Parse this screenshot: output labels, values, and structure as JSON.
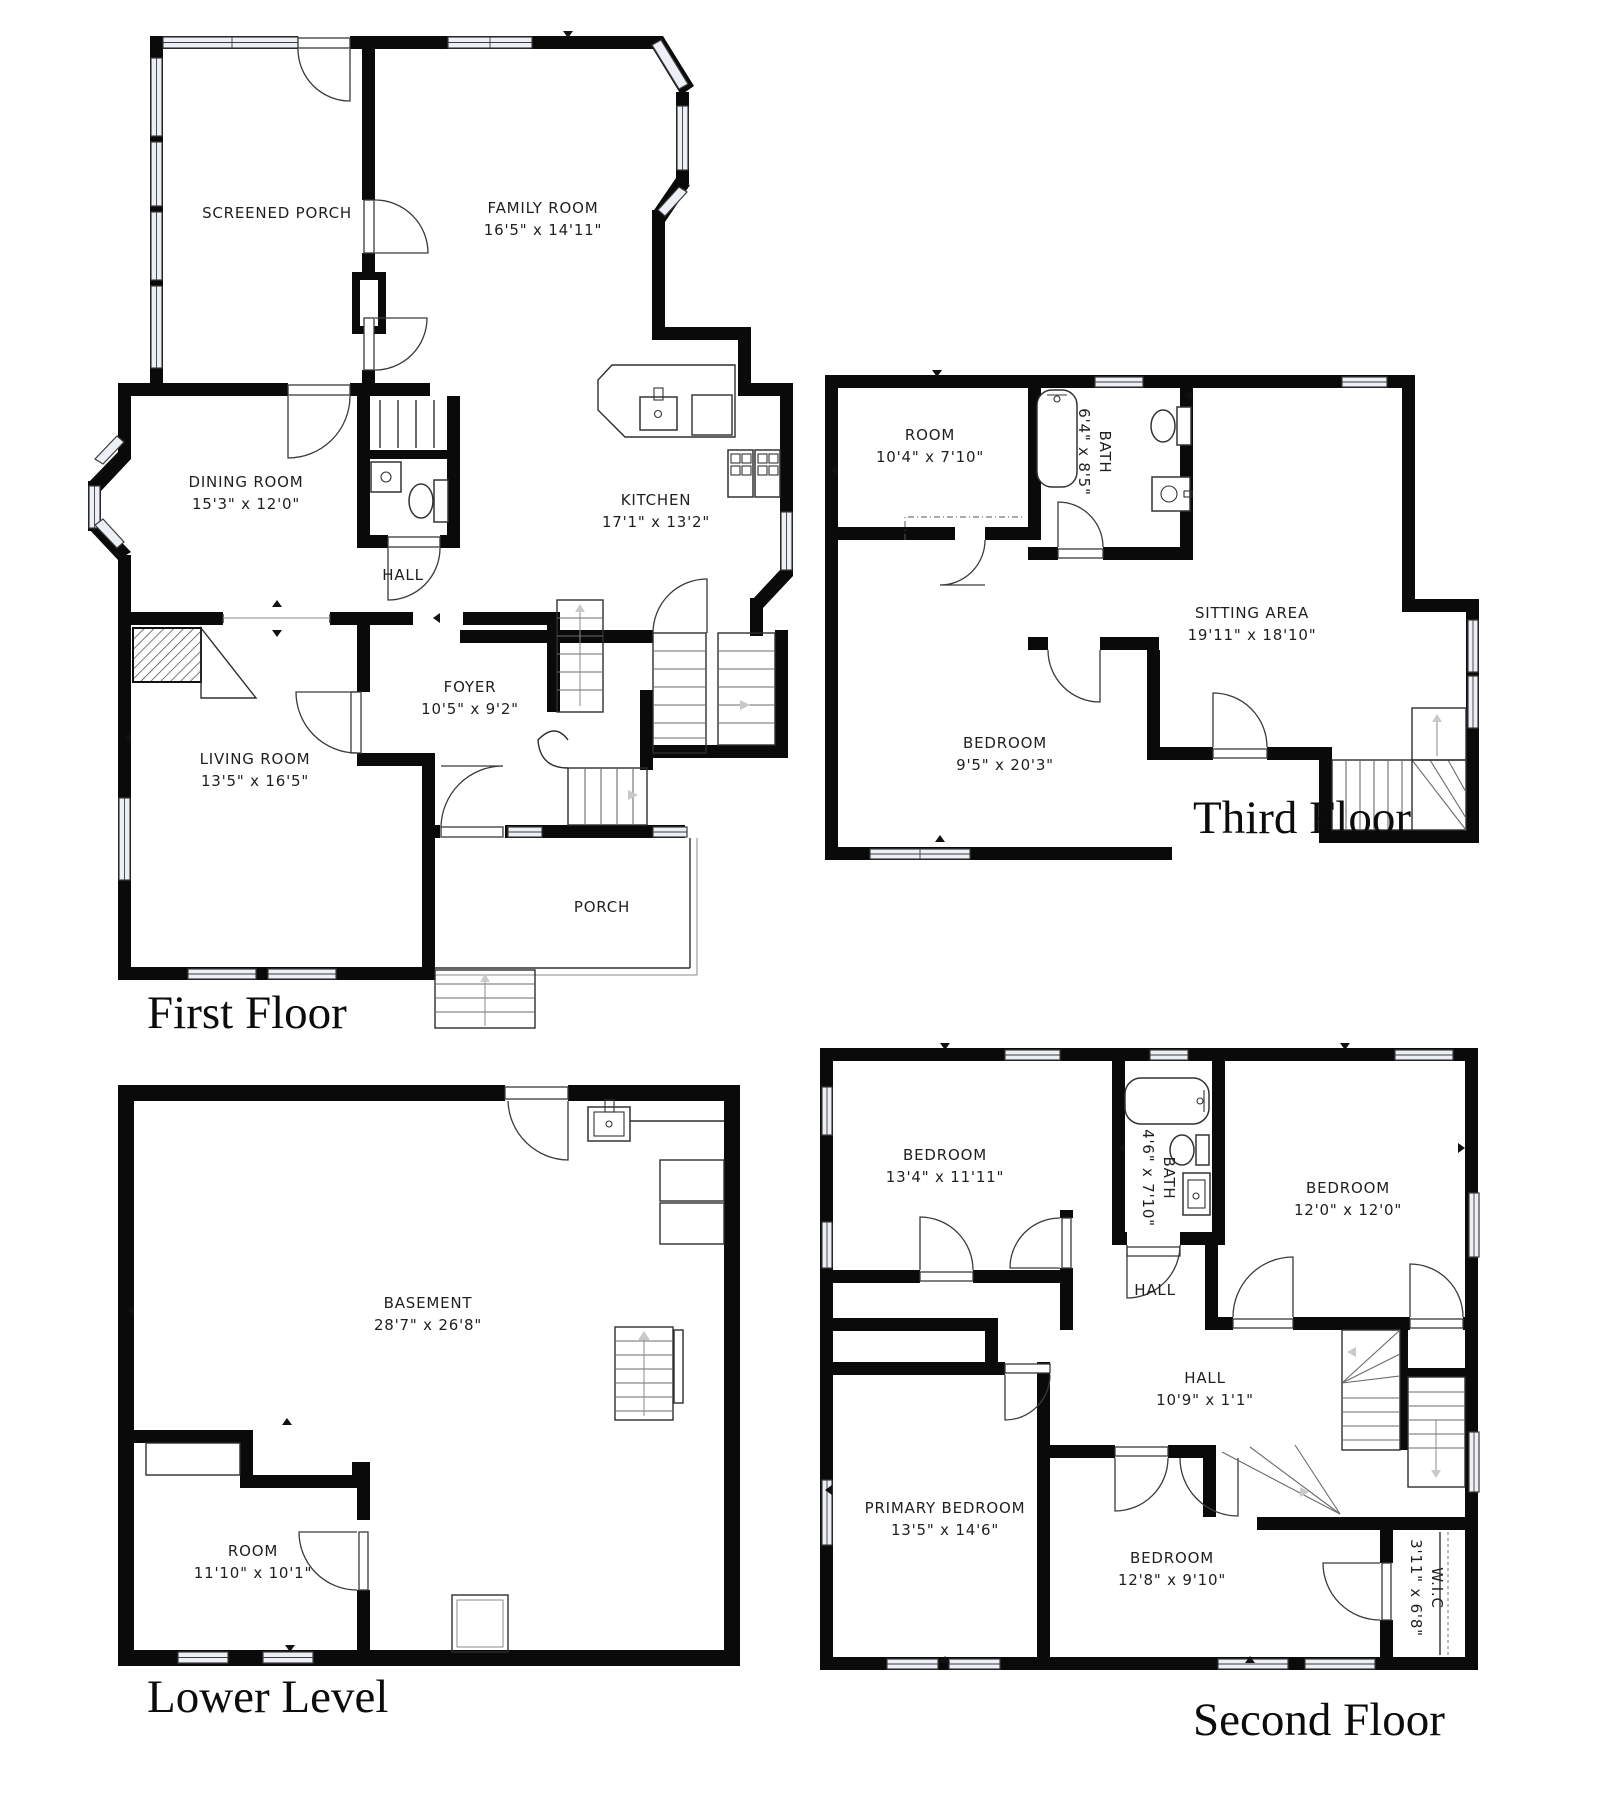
{
  "document_type": "residential floor plan sheet",
  "colors": {
    "walls": "#0a0a0a",
    "background": "#ffffff",
    "window_fill": "#edeff6",
    "stair_arrow": "#c9c9c9"
  },
  "floors": [
    {
      "id": "first",
      "title": "First Floor",
      "rooms": [
        {
          "name": "SCREENED PORCH",
          "dims": ""
        },
        {
          "name": "FAMILY ROOM",
          "dims": "16'5\" x 14'11\""
        },
        {
          "name": "DINING ROOM",
          "dims": "15'3\" x 12'0\""
        },
        {
          "name": "KITCHEN",
          "dims": "17'1\" x 13'2\""
        },
        {
          "name": "HALL",
          "dims": ""
        },
        {
          "name": "FOYER",
          "dims": "10'5\" x 9'2\""
        },
        {
          "name": "LIVING ROOM",
          "dims": "13'5\" x 16'5\""
        },
        {
          "name": "PORCH",
          "dims": ""
        }
      ]
    },
    {
      "id": "third",
      "title": "Third Floor",
      "rooms": [
        {
          "name": "ROOM",
          "dims": "10'4\" x 7'10\""
        },
        {
          "name": "BATH",
          "dims": "6'4\" x 8'5\"",
          "rotated": true
        },
        {
          "name": "SITTING AREA",
          "dims": "19'11\" x 18'10\""
        },
        {
          "name": "BEDROOM",
          "dims": "9'5\" x 20'3\""
        }
      ]
    },
    {
      "id": "lower",
      "title": "Lower Level",
      "rooms": [
        {
          "name": "BASEMENT",
          "dims": "28'7\" x 26'8\""
        },
        {
          "name": "ROOM",
          "dims": "11'10\" x 10'1\""
        }
      ]
    },
    {
      "id": "second",
      "title": "Second Floor",
      "rooms": [
        {
          "name": "BEDROOM",
          "dims": "13'4\" x 11'11\""
        },
        {
          "name": "BATH",
          "dims": "4'6\" x 7'10\"",
          "rotated": true
        },
        {
          "name": "BEDROOM",
          "dims": "12'0\" x 12'0\""
        },
        {
          "name": "HALL",
          "dims": ""
        },
        {
          "name": "HALL",
          "dims": "10'9\" x 1'1\""
        },
        {
          "name": "PRIMARY BEDROOM",
          "dims": "13'5\" x 14'6\""
        },
        {
          "name": "BEDROOM",
          "dims": "12'8\" x 9'10\""
        },
        {
          "name": "W.I.C",
          "dims": "3'11\" x 6'8\"",
          "rotated": true
        }
      ]
    }
  ]
}
